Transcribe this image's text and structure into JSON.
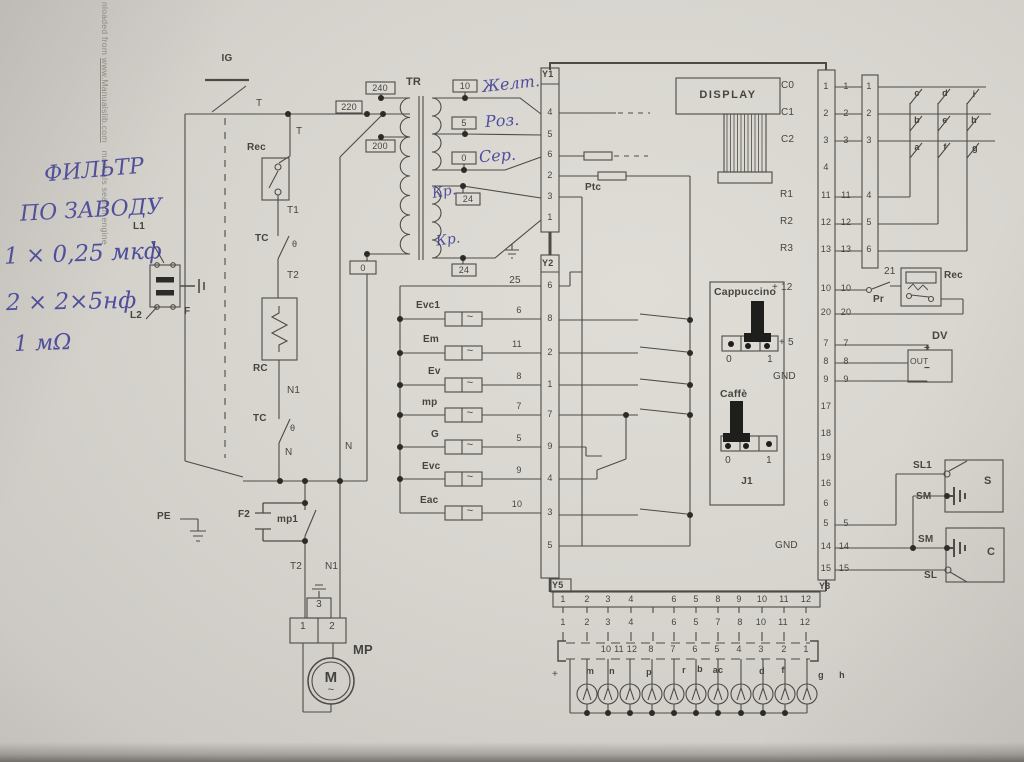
{
  "wm": {
    "part1": "nloaded from ",
    "link": "www.Manualslib.com",
    "part2": "manuals search engine"
  },
  "hand": {
    "note1": "ФИЛЬТР",
    "note2": "ПО ЗАВОДУ",
    "note3": "1 × 0,25 мкф",
    "note4": "2 × 2×5нф",
    "note5": "1 мΩ",
    "yellow": "Желт.",
    "pink": "Роз.",
    "grey": "Сер.",
    "red1": "Кр.",
    "red2": "Кр."
  },
  "left": {
    "ig": "IG",
    "t_top": "T",
    "t_mid": "T",
    "rec": "Rec",
    "t1": "T1",
    "tc1": "TC",
    "theta1": "θ",
    "t2": "T2",
    "rc": "RC",
    "n1": "N1",
    "tc2": "TC",
    "theta2": "θ",
    "n": "N",
    "n_rail": "N",
    "l1": "L1",
    "l2": "L2",
    "f": "F",
    "pe": "PE"
  },
  "motor": {
    "f2": "F2",
    "mp1": "mp1",
    "t2": "T2",
    "n1": "N1",
    "pin3": "3",
    "pin1": "1",
    "pin2": "2",
    "mp": "MP",
    "m": "M",
    "tilde": "~"
  },
  "tr": {
    "label": "TR",
    "tap240": "240",
    "tap220": "220",
    "tap200": "200",
    "tap0": "0",
    "sec10": "10",
    "sec5": "5",
    "sec0": "0",
    "sec24a": "24",
    "sec24b": "24"
  },
  "wire25": "25",
  "sym": {
    "tilde": "~"
  },
  "y1": {
    "label": "Y1",
    "pins": [
      "4",
      "5",
      "6",
      "2",
      "3",
      "1"
    ]
  },
  "y2": {
    "label": "Y2",
    "pins": [
      "6",
      "8",
      "2",
      "1",
      "7",
      "9",
      "4",
      "3",
      "5"
    ]
  },
  "y3": {
    "label": "Y3",
    "pins": [
      "1",
      "2",
      "3",
      "4",
      "11",
      "12",
      "13",
      "10",
      "20",
      "7",
      "8",
      "9",
      "17",
      "18",
      "19",
      "16",
      "6",
      "5",
      "14",
      "15"
    ],
    "ext": [
      "1",
      "2",
      "3",
      "11",
      "12",
      "13",
      "10",
      "20",
      "7",
      "8",
      "9",
      "5",
      "14",
      "15"
    ]
  },
  "y5": {
    "label": "Y5",
    "row1": [
      "1",
      "2",
      "3",
      "4",
      "6",
      "5",
      "8",
      "9",
      "10",
      "11",
      "12"
    ],
    "row2": [
      "1",
      "2",
      "3",
      "4",
      "6",
      "5",
      "7",
      "8",
      "10",
      "11",
      "12"
    ],
    "row3": [
      "10",
      "11",
      "12",
      "8",
      "7",
      "6",
      "5",
      "4",
      "3",
      "2",
      "1"
    ]
  },
  "board": {
    "display": "DISPLAY",
    "ptc": "Ptc",
    "c0": "C0",
    "c1": "C1",
    "c2": "C2",
    "r1": "R1",
    "r2": "R2",
    "r3": "R3",
    "p12": "+ 12",
    "p5": "+ 5",
    "gnd1": "GND",
    "gnd2": "GND"
  },
  "j1": {
    "cappuccino": "Cappuccino",
    "caffe": "Caffè",
    "c0": "0",
    "c1": "1",
    "f0": "0",
    "f1": "1",
    "label": "J1"
  },
  "loads": [
    {
      "name": "Evc1",
      "wire": "6"
    },
    {
      "name": "Em",
      "wire": "11"
    },
    {
      "name": "Ev",
      "wire": "8"
    },
    {
      "name": "mp",
      "wire": "7"
    },
    {
      "name": "G",
      "wire": "5"
    },
    {
      "name": "Evc",
      "wire": "9"
    },
    {
      "name": "Eac",
      "wire": "10"
    }
  ],
  "keypad": {
    "pins": [
      "1",
      "2",
      "3",
      "4",
      "5",
      "6"
    ],
    "keys": [
      "c",
      "d",
      "i",
      "b",
      "e",
      "h",
      "a",
      "f",
      "g"
    ]
  },
  "right": {
    "n21": "21",
    "rec": "Rec",
    "pr": "Pr",
    "dv": "DV",
    "plus": "+",
    "out": "OUT",
    "minus": "−",
    "sl1": "SL1",
    "sm1": "SM",
    "s": "S",
    "sm2": "SM",
    "sl": "SL",
    "c": "C"
  },
  "lamps": {
    "plus": "+",
    "labels": [
      "m",
      "n",
      "p",
      "r",
      "b",
      "ac",
      "d",
      "f",
      "g",
      "h"
    ]
  },
  "colors": {
    "ink": "#3c3c96",
    "line": "#4c4b46",
    "paper": "#d8d5cf"
  }
}
